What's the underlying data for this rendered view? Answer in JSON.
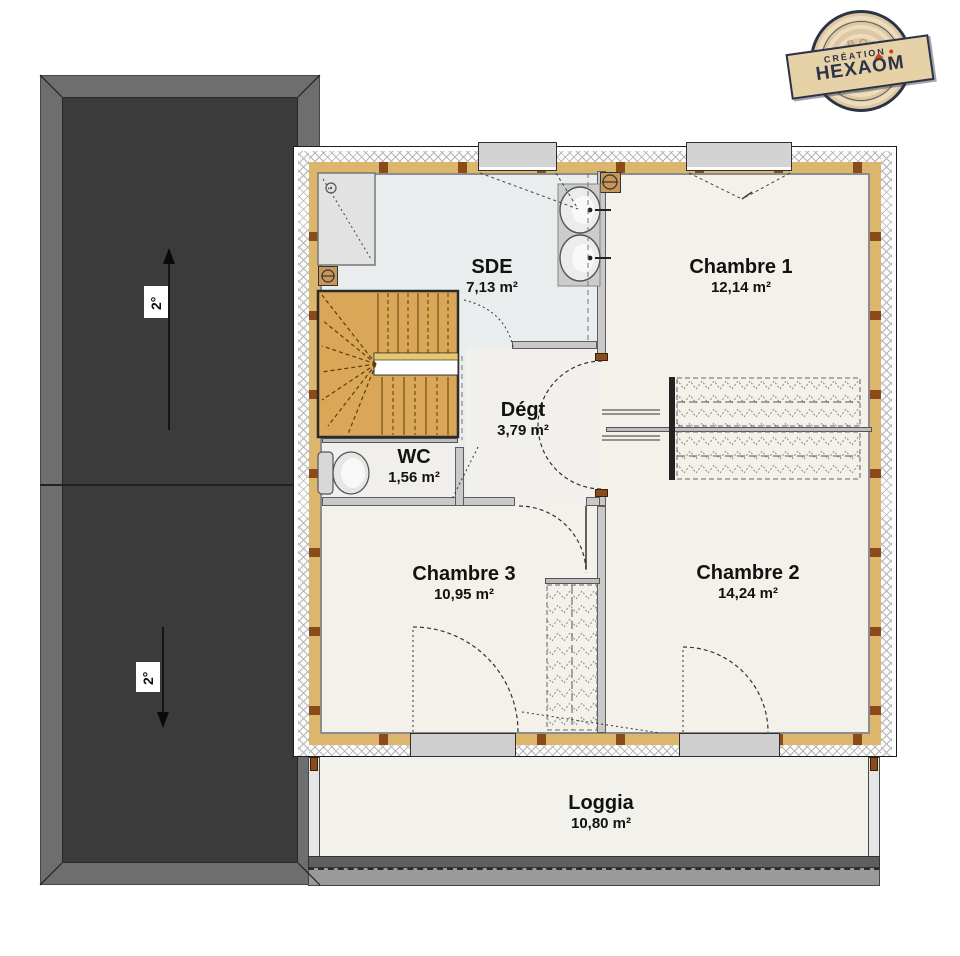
{
  "plan": {
    "rooms": [
      {
        "name": "SDE",
        "area": "7,13 m²"
      },
      {
        "name": "Chambre 1",
        "area": "12,14 m²"
      },
      {
        "name": "Dégt",
        "area": "3,79 m²"
      },
      {
        "name": "WC",
        "area": "1,56 m²"
      },
      {
        "name": "Chambre 3",
        "area": "10,95 m²"
      },
      {
        "name": "Chambre 2",
        "area": "14,24 m²"
      },
      {
        "name": "Loggia",
        "area": "10,80 m²"
      }
    ]
  },
  "roof": {
    "slope_upper": "2°",
    "slope_lower": "2°"
  },
  "logo": {
    "creation": "CRÉATION",
    "brand_pre": "HEXA",
    "brand_o": "O",
    "brand_post": "M",
    "ring_text": "BOIS"
  },
  "colors": {
    "roof_dark": "#3b3b3b",
    "roof_border": "#6e6e6e",
    "wall_tan": "#dcb66c",
    "wall_block_brown": "#8a4a1a",
    "stair_wood": "#d9a757",
    "accent_red": "#d23c1e",
    "sde_floor": "#e9eded",
    "room_floor": "#f4f1ea"
  }
}
